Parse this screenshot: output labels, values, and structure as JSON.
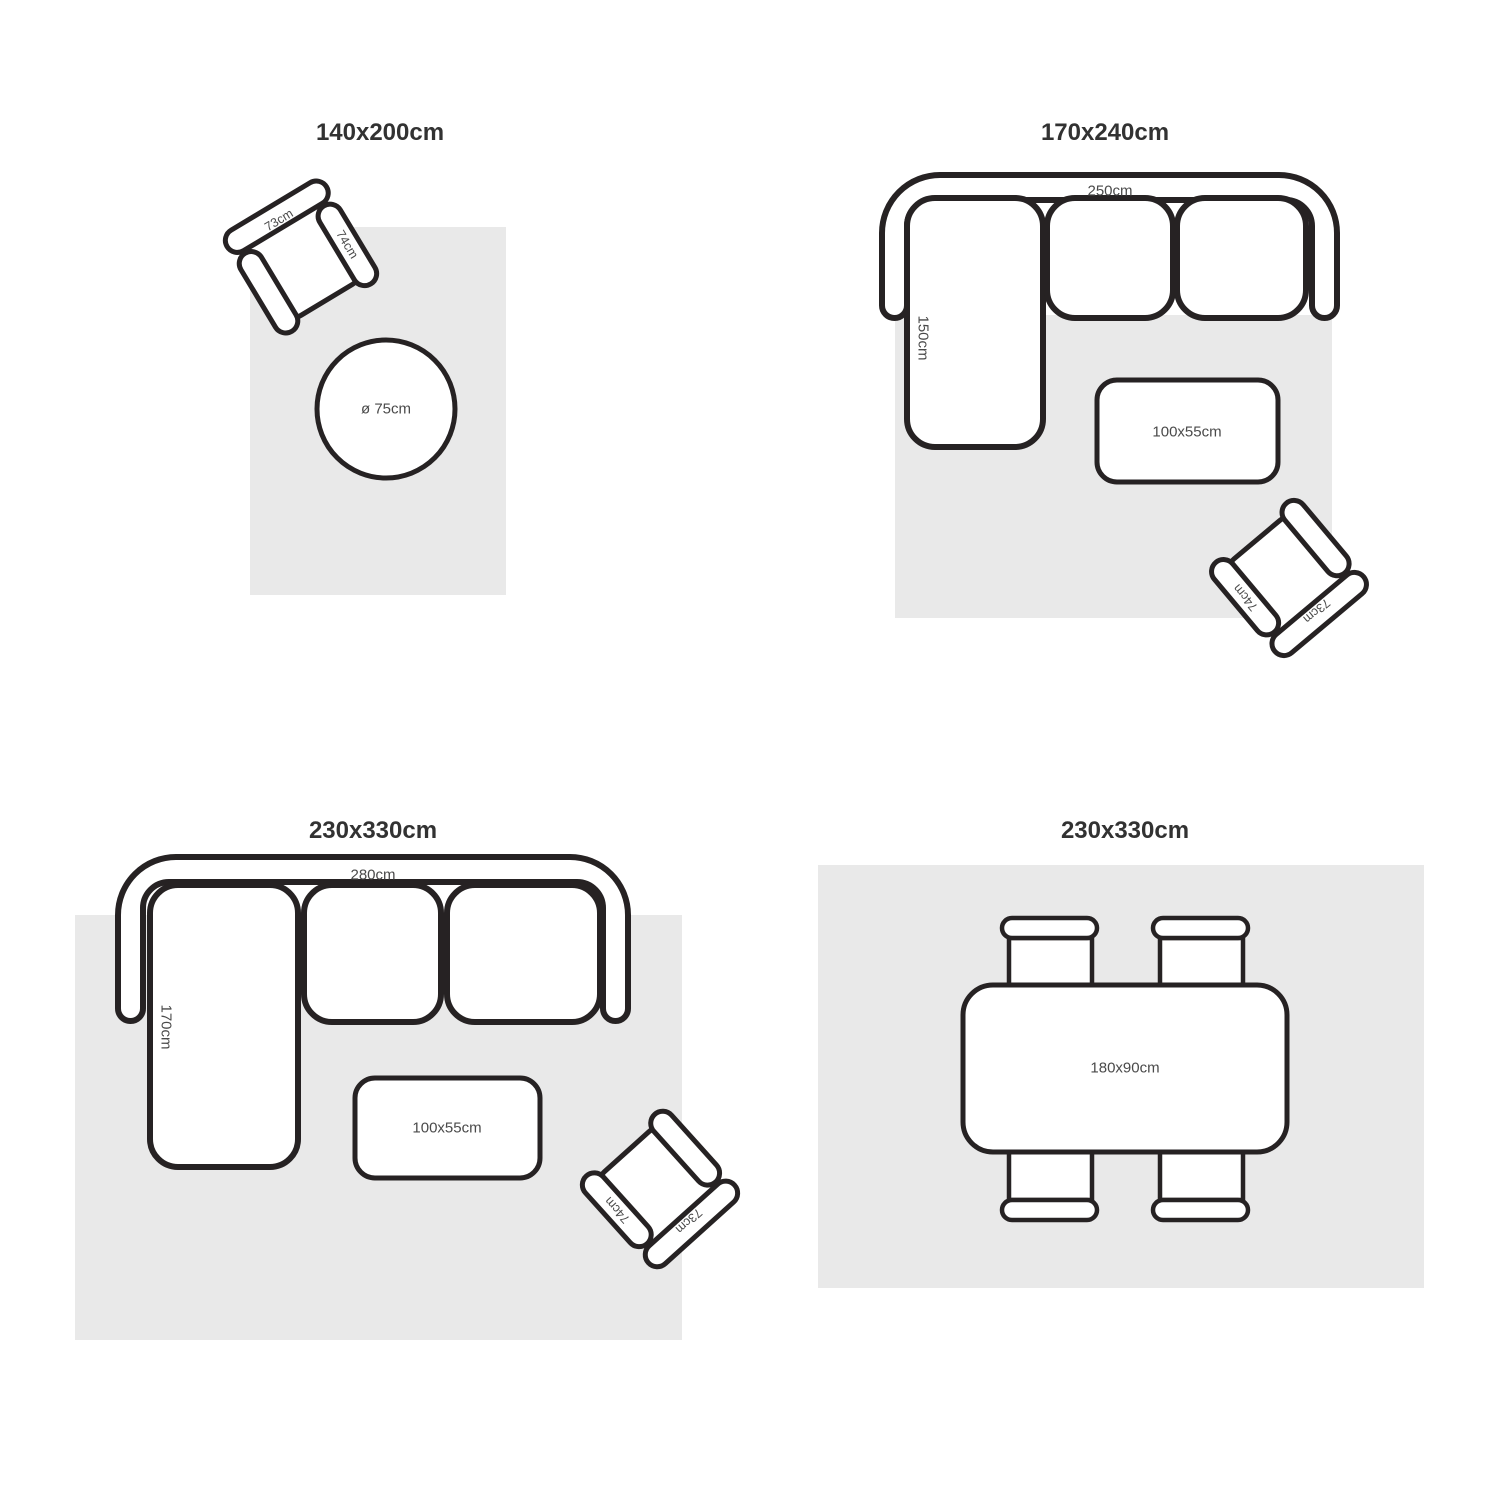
{
  "colors": {
    "outline": "#262223",
    "rug": "#e9e9e9",
    "title_text": "#323232",
    "dim_text": "#4a4a4a",
    "background": "#ffffff"
  },
  "panels": [
    {
      "title": "140x200cm",
      "armchair": {
        "back_label": "73cm",
        "arm_label": "74cm"
      },
      "round_table": {
        "label": "ø 75cm"
      }
    },
    {
      "title": "170x240cm",
      "sofa": {
        "width_label": "250cm",
        "depth_label": "150cm"
      },
      "coffee_table": {
        "label": "100x55cm"
      },
      "armchair": {
        "back_label": "73cm",
        "arm_label": "74cm"
      }
    },
    {
      "title": "230x330cm",
      "sofa": {
        "width_label": "280cm",
        "depth_label": "170cm"
      },
      "coffee_table": {
        "label": "100x55cm"
      },
      "armchair": {
        "back_label": "73cm",
        "arm_label": "74cm"
      }
    },
    {
      "title": "230x330cm",
      "dining_table": {
        "label": "180x90cm"
      }
    }
  ]
}
